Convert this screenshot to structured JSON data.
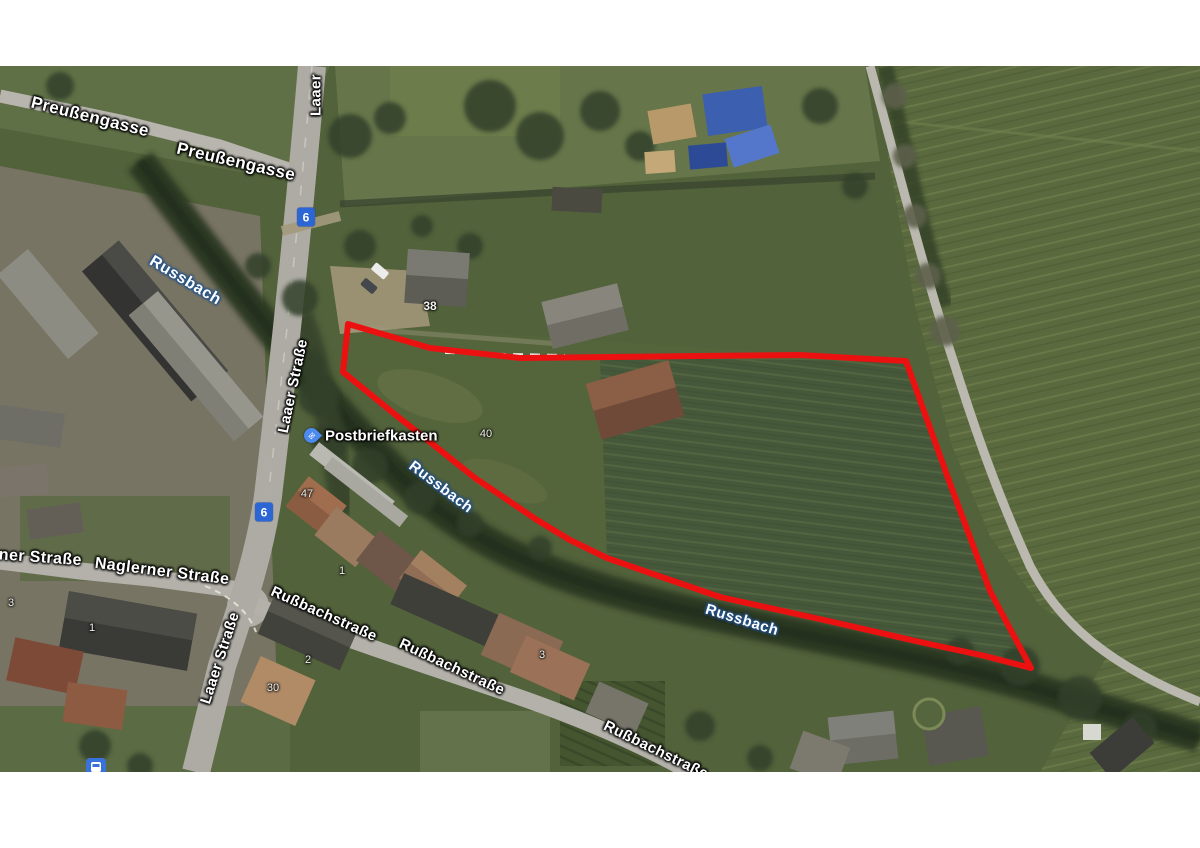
{
  "map": {
    "streets": {
      "preussengasse_a": "Preußengasse",
      "preussengasse_b": "Preußengasse",
      "laaer_short": "Laaer",
      "laaer_strasse_mid": "Laaer Straße",
      "laaer_strasse_south": "Laaer Straße",
      "naglerner_partial": "rner Straße",
      "naglerner_strasse": "Naglerner Straße",
      "russbachstrasse_a": "Rußbachstraße",
      "russbachstrasse_b": "Rußbachstraße",
      "russbachstrasse_c": "Rußbachstraße"
    },
    "water_labels": {
      "russbach_nw": "Russbach",
      "russbach_mid": "Russbach",
      "russbach_se": "Russbach"
    },
    "route_shield": {
      "number": "6",
      "color": "#2b66d4"
    },
    "poi": {
      "postbriefkasten": {
        "label": "Postbriefkasten",
        "pin_color": "#4d8af0",
        "icon": "mail-envelope"
      }
    },
    "house_numbers": {
      "n38": "38",
      "n40": "40",
      "n47": "47",
      "n1_laaer": "1",
      "n3_west": "3",
      "n1_naglerner": "1",
      "n2_naglerner": "2",
      "n30": "30",
      "n3_russbach": "3"
    },
    "transit_stop_icon": "bus"
  },
  "overlay": {
    "type": "parcel-outline",
    "stroke_color": "#ec1111",
    "stroke_width": 6,
    "points": "348,258 430,282 520,292 610,291 700,290 800,289 906,295 948,412 990,525 1031,602 985,590 920,576 833,556 720,531 650,507 607,492 570,474 537,454 475,412 440,384 397,350 343,306"
  }
}
